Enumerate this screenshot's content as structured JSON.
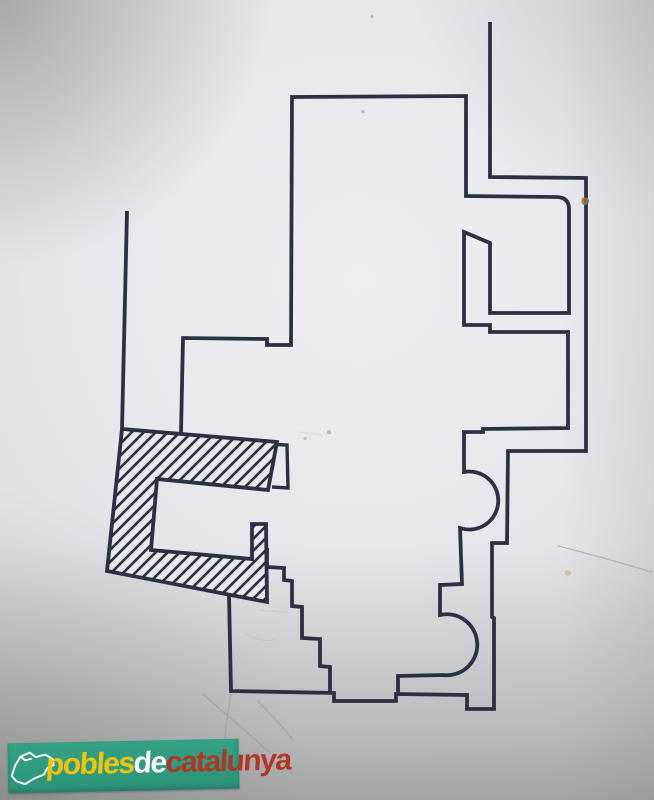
{
  "logo": {
    "pobles": "pobles",
    "de": "de",
    "catalunya": "catalunya",
    "green": "#2f9c7f",
    "yellow": "#f2c50f",
    "red": "#b23528"
  },
  "colors": {
    "ink": "#2b3144",
    "paper": "#e5e7ea"
  },
  "plan": {
    "left_wall": "M127,211 L122,429",
    "church_outline": "M181,433 L183,338 L267,339 L267,345 L291,345 L292,97 L466,96 L466,196 L556,197 Q569,197 569,209 L569,313 L490,313 L490,243 L464,232 L464,325 L490,325 L490,332 L568,332 L568,428 L483,429 L483,432 L464,432 L464,472 A29,29 0 1 1 460,528 L462,584 L440,585 L440,615 A30.5,30.5 0 1 1 443,675 L398,676 L398,693",
    "right_outer": "M490,22 L490,177 L586,178 L586,451 L508,451 L507,543 L492,543 L492,617 L494,618 L494,709 L467,709 L467,695 L396,694 L396,701 L334,701 L334,693 L231,691 L229,595",
    "staircase": "M267,548 L267,567 L284,568 L284,580 L292,581 L292,606 L302,607 L302,638 L320,639 L320,666 L330,667 L330,692",
    "tower_tab": "M269,447 L269,444 L287,445 L288,488 L272,487",
    "tower": "M122,429 L277,442 L268,490 L157,479 L151,550 L252,559 L252,524 L266,524 L267,602 L107,571 Z",
    "stain_brown": "M582,198 q5,-2 7,2 q1,4 -4,5 q-5,0 -3,-7 z",
    "stain_tan": "M565,571 q4,-2 6,1 q1,3 -3,4 q-4,0 -3,-5 z",
    "specks": "M363,110 a1.6,1.6 0 1 0 .1,0 M372,15 a1.5,1.5 0 1 0 .1,0 M329,430 a2.2,2.2 0 1 0 .1,0 M305,437 a1.6,1.6 0 1 0 .1,0",
    "pencil": [
      "M203,694 C224,713 250,734 270,753",
      "M233,680 C229,702 227,718 225,738",
      "M258,701 C272,716 283,727 293,740",
      "M558,546 C590,554 625,564 652,572"
    ],
    "pencil_faint": [
      "M260,610 l28,3",
      "M246,634 c10,6 22,8 31,5",
      "M300,432 l22,3"
    ]
  }
}
